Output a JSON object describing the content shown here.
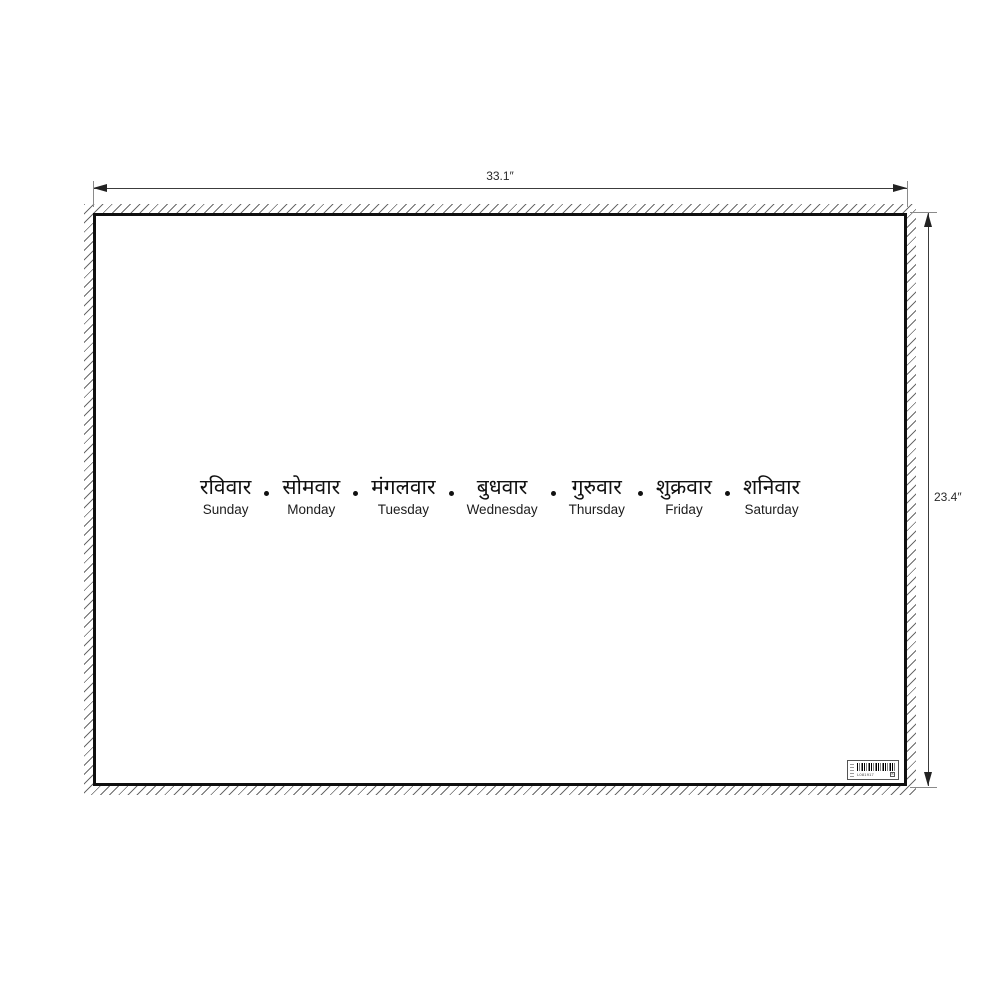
{
  "dimensions": {
    "width_label": "33.1″",
    "height_label": "23.4″"
  },
  "days": {
    "items": [
      {
        "hindi": "रविवार",
        "english": "Sunday"
      },
      {
        "hindi": "सोमवार",
        "english": "Monday"
      },
      {
        "hindi": "मंगलवार",
        "english": "Tuesday"
      },
      {
        "hindi": "बुधवार",
        "english": "Wednesday"
      },
      {
        "hindi": "गुरुवार",
        "english": "Thursday"
      },
      {
        "hindi": "शुक्रवार",
        "english": "Friday"
      },
      {
        "hindi": "शनिवार",
        "english": "Saturday"
      }
    ]
  },
  "sticker": {
    "code": "L081917",
    "grade": "B"
  },
  "colors": {
    "ink": "#111111",
    "border": "#0f0f0f",
    "dimension_line": "#3c3c3c",
    "hatch": "#6a6a6a"
  }
}
